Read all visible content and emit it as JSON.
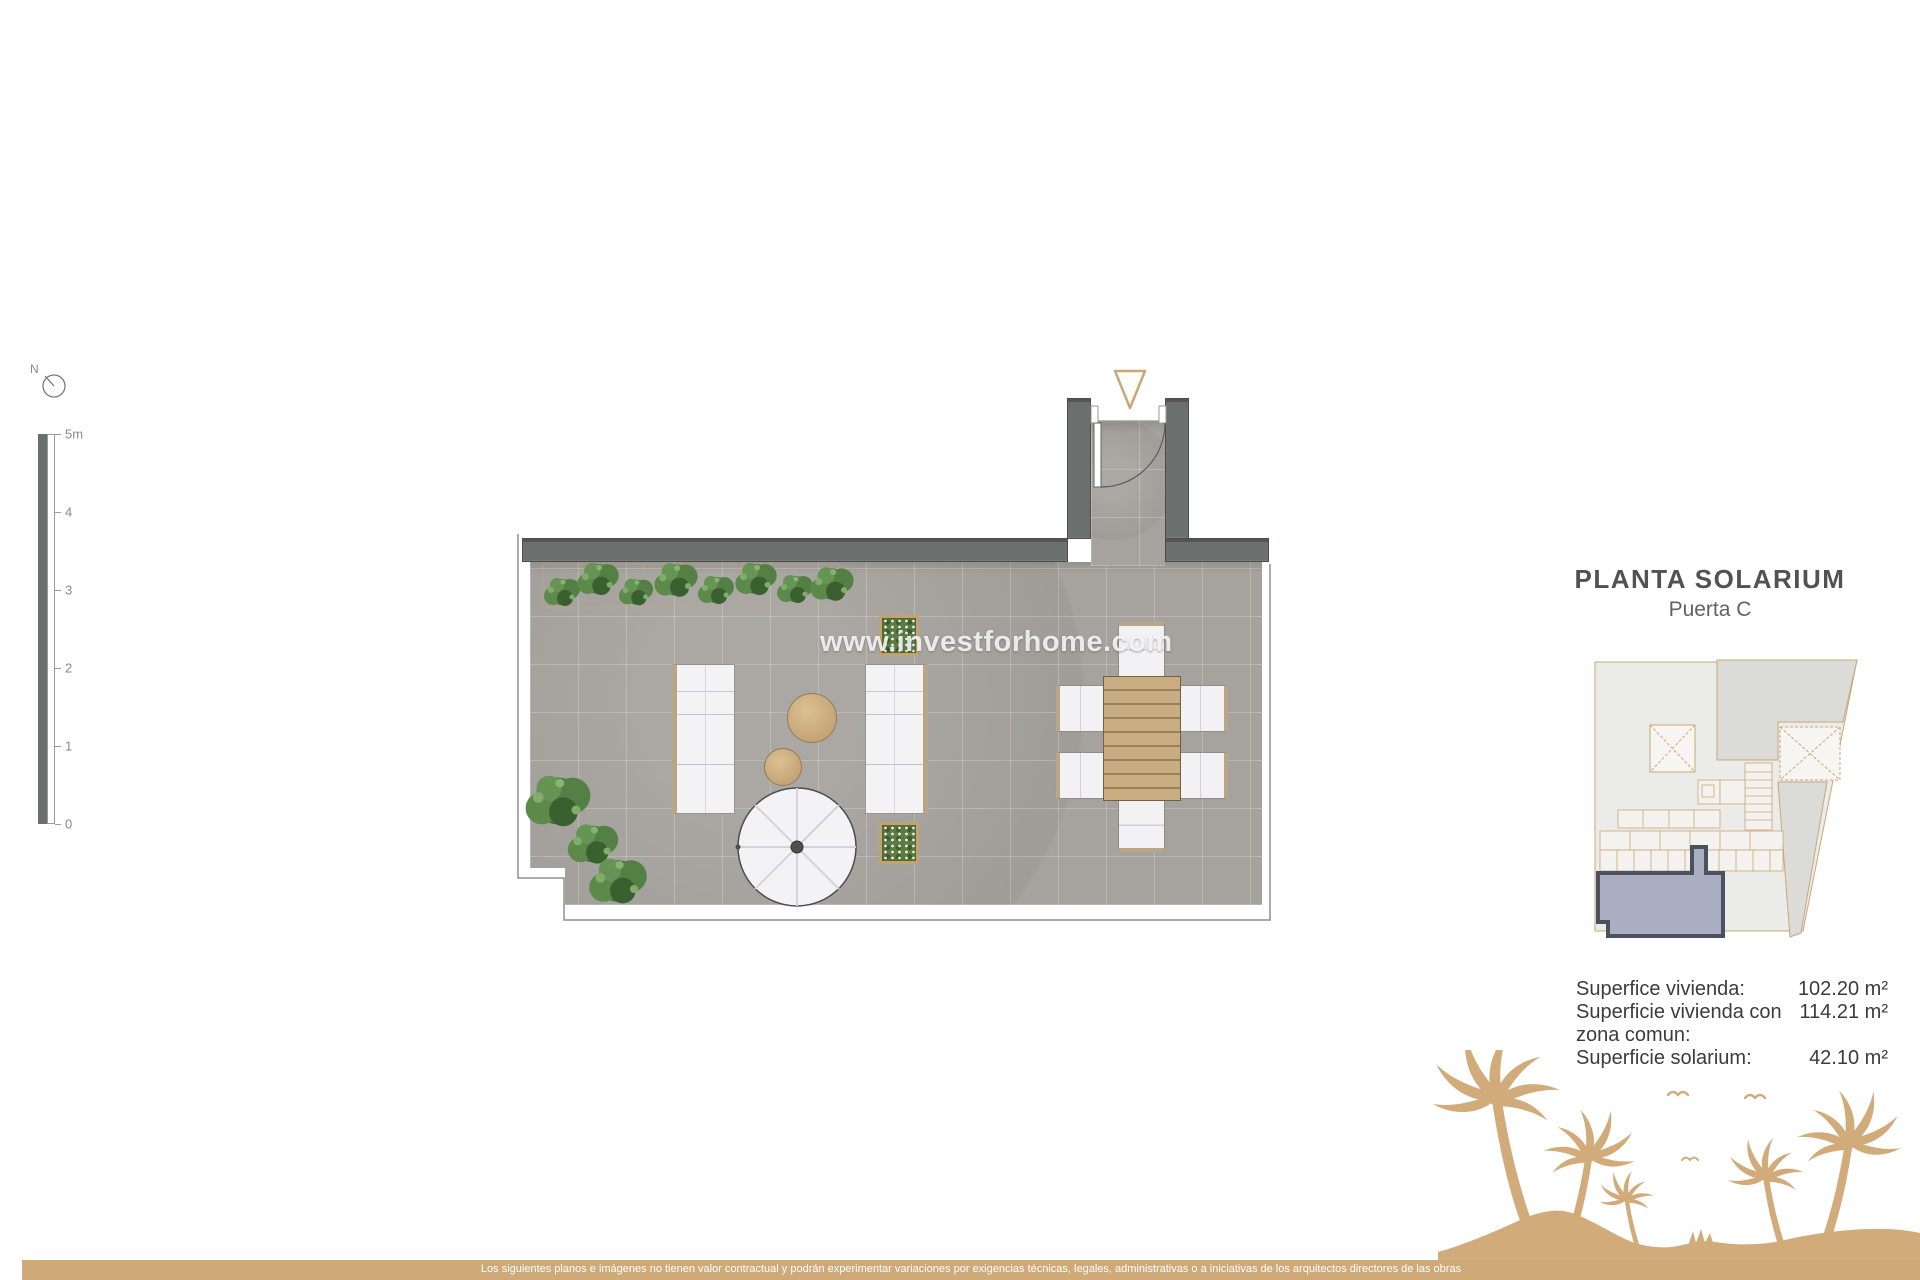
{
  "compass": {
    "north_label": "N"
  },
  "scale_bar": {
    "unit_ticks": [
      "5m",
      "4",
      "3",
      "2",
      "1",
      "0"
    ]
  },
  "watermark": {
    "text": "www.investforhome.com"
  },
  "info_panel": {
    "title": "PLANTA SOLARIUM",
    "subtitle": "Puerta C",
    "areas": [
      {
        "label": "Superfice vivienda:",
        "value": "102.20 m²"
      },
      {
        "label": "Superficie vivienda con zona comun:",
        "value": "114.21 m²"
      },
      {
        "label": "Superficie solarium:",
        "value": "42.10 m²"
      }
    ]
  },
  "footer": {
    "disclaimer": "Los siguientes planos e imágenes no tienen valor contractual y podrán experimentar variaciones por exigencias técnicas, legales, administrativas o a iniciativas de los arquitectos directores de las obras"
  },
  "colors": {
    "accent_tan": "#cfaa78",
    "wall_gray": "#6b6f6e",
    "floor_gray": "#a6a39e",
    "highlight_unit_fill": "#a9afc1",
    "highlight_unit_border": "#4c5160"
  }
}
